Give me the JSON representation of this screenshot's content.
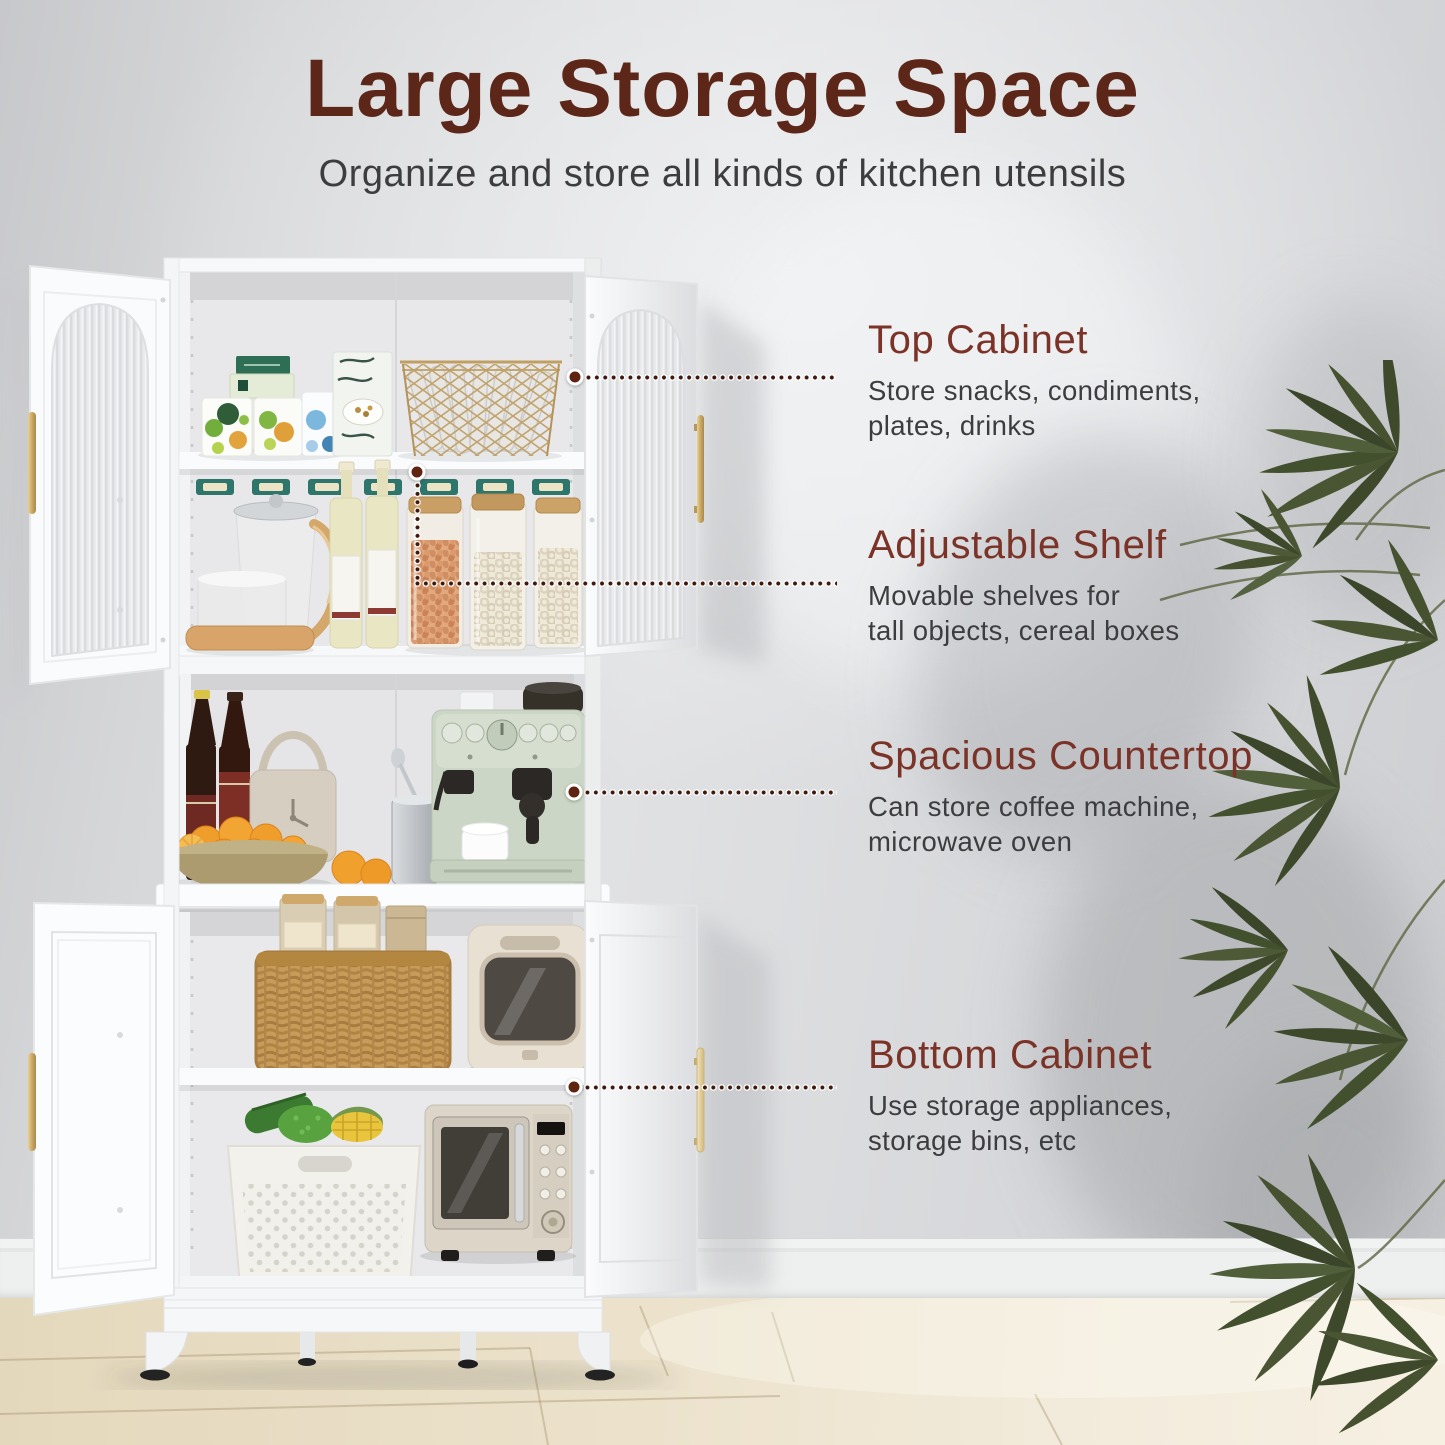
{
  "page": {
    "title": "Large Storage Space",
    "subtitle": "Organize and store all kinds of kitchen utensils"
  },
  "callouts": [
    {
      "title": "Top Cabinet",
      "line1": "Store snacks, condiments,",
      "line2": "plates, drinks"
    },
    {
      "title": "Adjustable Shelf",
      "line1": "Movable shelves for",
      "line2": "tall objects, cereal boxes"
    },
    {
      "title": "Spacious Countertop",
      "line1": "Can store coffee machine,",
      "line2": "microwave oven"
    },
    {
      "title": "Bottom Cabinet",
      "line1": "Use storage appliances,",
      "line2": "storage bins, etc"
    }
  ],
  "colors": {
    "title_text": "#5c2718",
    "callout_heading": "#7b3328",
    "body_text": "#3d3d3f",
    "leader_dot": "#5f2312",
    "accent_gold": "#c9ab6d",
    "cabinet_white": "#f7f8f9",
    "wall_gray": "#d8d9db",
    "floor_wood": "#eadfc6",
    "plant_green": "#46522f"
  }
}
